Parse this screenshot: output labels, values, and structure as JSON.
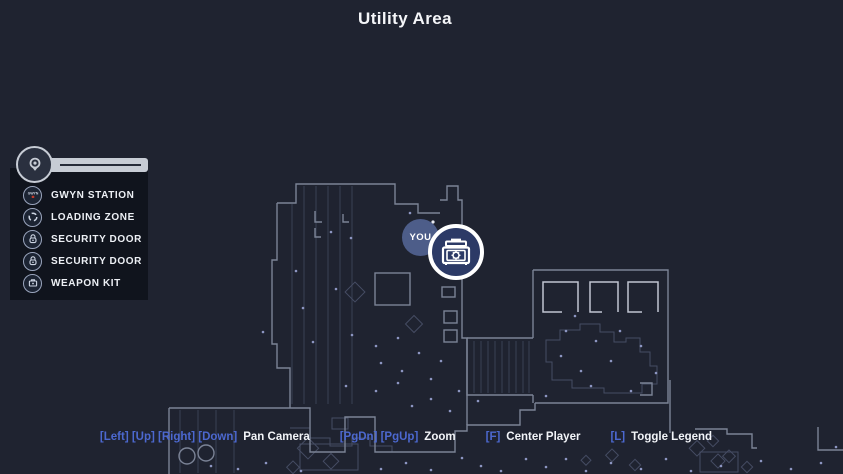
{
  "header": {
    "title": "Utility Area"
  },
  "legend": {
    "header_icon": "map-pin-icon",
    "items": [
      {
        "icon": "gwyn-station-icon",
        "label": "GWYN STATION"
      },
      {
        "icon": "loading-zone-icon",
        "label": "LOADING ZONE"
      },
      {
        "icon": "security-door-icon",
        "label": "SECURITY DOOR"
      },
      {
        "icon": "security-door-icon",
        "label": "SECURITY DOOR"
      },
      {
        "icon": "weapon-kit-icon",
        "label": "WEAPON KIT"
      }
    ]
  },
  "map": {
    "player_label": "YOU",
    "selected_marker_icon": "weapon-kit-icon"
  },
  "controls": {
    "groups": [
      {
        "keys": "[Left] [Up] [Right] [Down]",
        "action": "Pan Camera"
      },
      {
        "keys": "[PgDn] [PgUp]",
        "action": "Zoom"
      },
      {
        "keys": "[F]",
        "action": "Center Player"
      },
      {
        "keys": "[L]",
        "action": "Toggle Legend"
      }
    ]
  },
  "colors": {
    "background": "#1f2330",
    "key_hint_blue": "#4c68cf",
    "text_white": "#f2f4f8",
    "map_line_bright": "#c0c5d1",
    "map_line": "#7b8396",
    "map_line_faint": "#454c63",
    "map_dot": "#8d96c2",
    "marker_fill": "#2c3a66",
    "marker_ring": "#ffffff",
    "player_fill": "#56689c",
    "legend_bar": "#c7ccd5",
    "gwyn_red": "#c0392b"
  }
}
